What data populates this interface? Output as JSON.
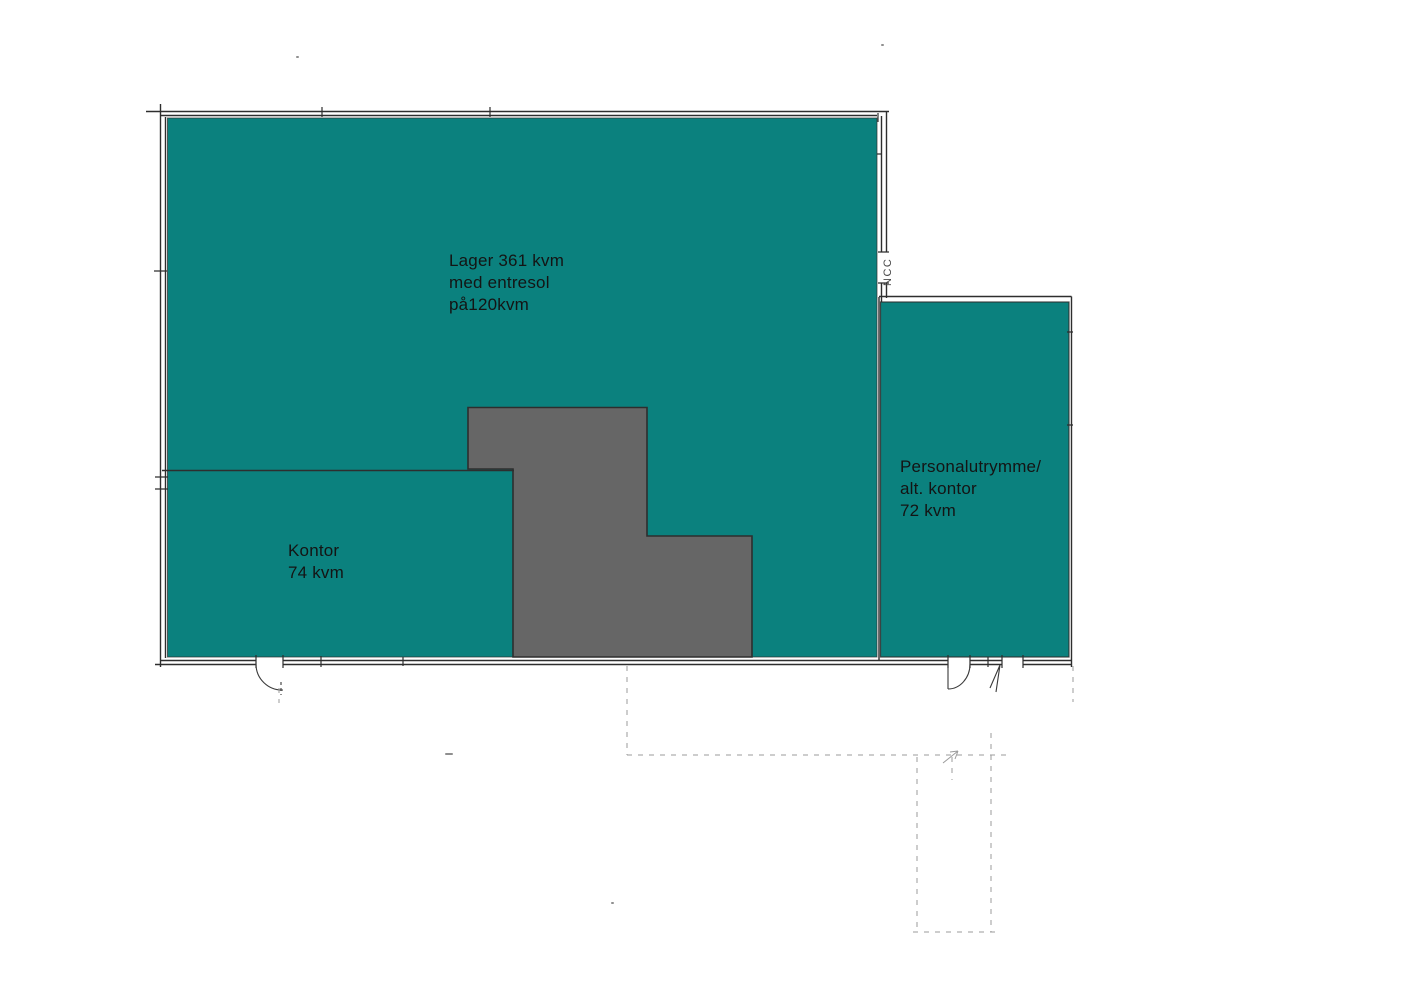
{
  "page": {
    "background": "#ffffff"
  },
  "colors": {
    "room_fill": "#0b817e",
    "core_fill": "#666666",
    "wall_line": "#2e2e2e",
    "door_line": "#3a3a3a",
    "faint_line": "#9b9b9b",
    "speck": "#8f8f8f",
    "text": "#141414",
    "stamp_text": "#4a4a4a"
  },
  "rooms": [
    {
      "id": "lager",
      "lines": [
        "Lager 361 kvm",
        "med entresol",
        "på120kvm"
      ],
      "area_kvm": 361,
      "entresol_kvm": 120
    },
    {
      "id": "kontor",
      "lines": [
        "Kontor",
        "74 kvm"
      ],
      "area_kvm": 74
    },
    {
      "id": "personalutrymme",
      "lines": [
        "Personalutrymme/",
        "alt. kontor",
        "72 kvm"
      ],
      "area_kvm": 72
    }
  ],
  "annotations": {
    "builder_stamp": "NCC"
  }
}
